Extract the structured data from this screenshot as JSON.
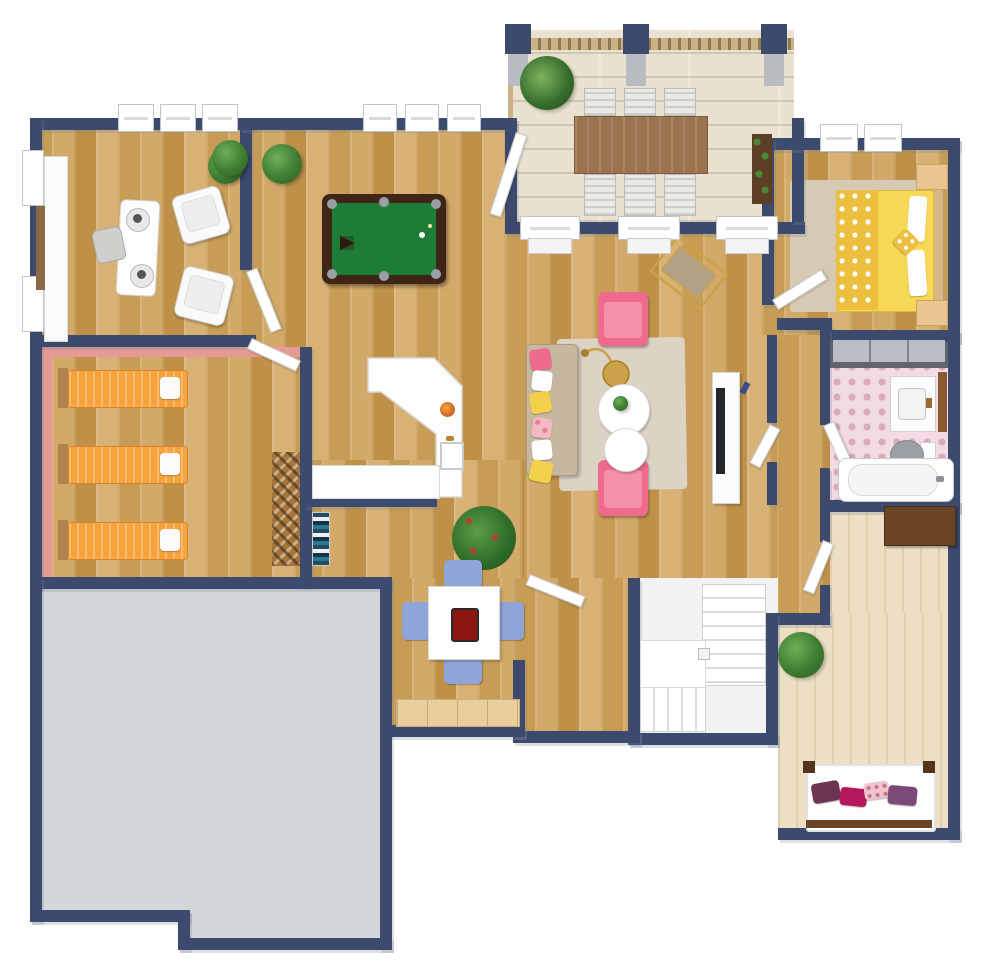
{
  "meta": {
    "description": "Top-down 3D rendered residential floor plan, no text labels visible",
    "view": "bird's-eye 3D floor plan render"
  },
  "colors": {
    "wall": "#3c4a6e",
    "wood": "#cda45f",
    "deck": "#eae2d0",
    "gray": "#d3d7d9",
    "cream": "#ecdfc4",
    "pinkWall": "#e59a95",
    "bathTile": "#f2dbe2",
    "bathDot": "#d8aabb",
    "orangeBed": "#f6a33c",
    "poolGreen": "#1d7c35",
    "poolFrame": "#3f2418",
    "pinkChair": "#ee6b8d",
    "sofa": "#c8b7a0",
    "rug": "#ddd3c5",
    "yellowBed": "#f7d854",
    "yellowPattern": "#edbf3f",
    "blueChair": "#8fa5d9",
    "tableBrown": "#9c7350",
    "stairWhite": "#f2f2f2",
    "woodFurn": "#b3814d",
    "darkWood": "#6b4426",
    "plantGreen": "#3e7d32",
    "gold": "#c9a24a",
    "closetPanel": "#b9bec4",
    "gameBoardRed": "#8e1612",
    "plumPillow": "#6e3553",
    "magentaPillow": "#b5175c",
    "purplePillow": "#7c4a78"
  },
  "rooms": [
    {
      "id": "office",
      "furniture": [
        "desk",
        "office-chair",
        "armchair",
        "armchair",
        "cabinet-row",
        "plant",
        "floor-mat"
      ]
    },
    {
      "id": "game-room",
      "furniture": [
        "pool-table",
        "plant",
        "plant"
      ]
    },
    {
      "id": "deck",
      "furniture": [
        "outdoor-dining-table",
        "deck-chair-x6",
        "palm-plant",
        "trellis-plant",
        "railing",
        "posts"
      ]
    },
    {
      "id": "living-room",
      "furniture": [
        "sofa",
        "pink-armchair",
        "pink-armchair",
        "round-coffee-table",
        "round-coffee-table",
        "arc-floor-lamp",
        "area-rug",
        "gold-magazine-stand",
        "tv-console"
      ]
    },
    {
      "id": "kitchen",
      "furniture": [
        "angled-island-counter",
        "sink",
        "fruit-bowl",
        "wall-counter",
        "bookshelf"
      ]
    },
    {
      "id": "bunk-room",
      "furniture": [
        "single-bed-orange",
        "single-bed-orange",
        "single-bed-orange",
        "lattice-wine-rack"
      ]
    },
    {
      "id": "breakfast-nook",
      "furniture": [
        "square-table",
        "blue-chair-x4",
        "game-board",
        "sideboard",
        "tomato-plant"
      ]
    },
    {
      "id": "stair-hall",
      "furniture": [
        "winder-staircase"
      ]
    },
    {
      "id": "yellow-bedroom",
      "furniture": [
        "double-bed-yellow",
        "nightstand",
        "nightstand",
        "area-rug"
      ]
    },
    {
      "id": "closet",
      "furniture": [
        "sliding-door-wardrobe"
      ]
    },
    {
      "id": "bathroom",
      "furniture": [
        "vanity-sink",
        "toilet",
        "bathtub",
        "wall-shelf"
      ]
    },
    {
      "id": "lower-bedroom",
      "furniture": [
        "bed-white-purple-pillows",
        "dark-dresser",
        "plant"
      ]
    },
    {
      "id": "storage-room",
      "furniture": []
    }
  ]
}
